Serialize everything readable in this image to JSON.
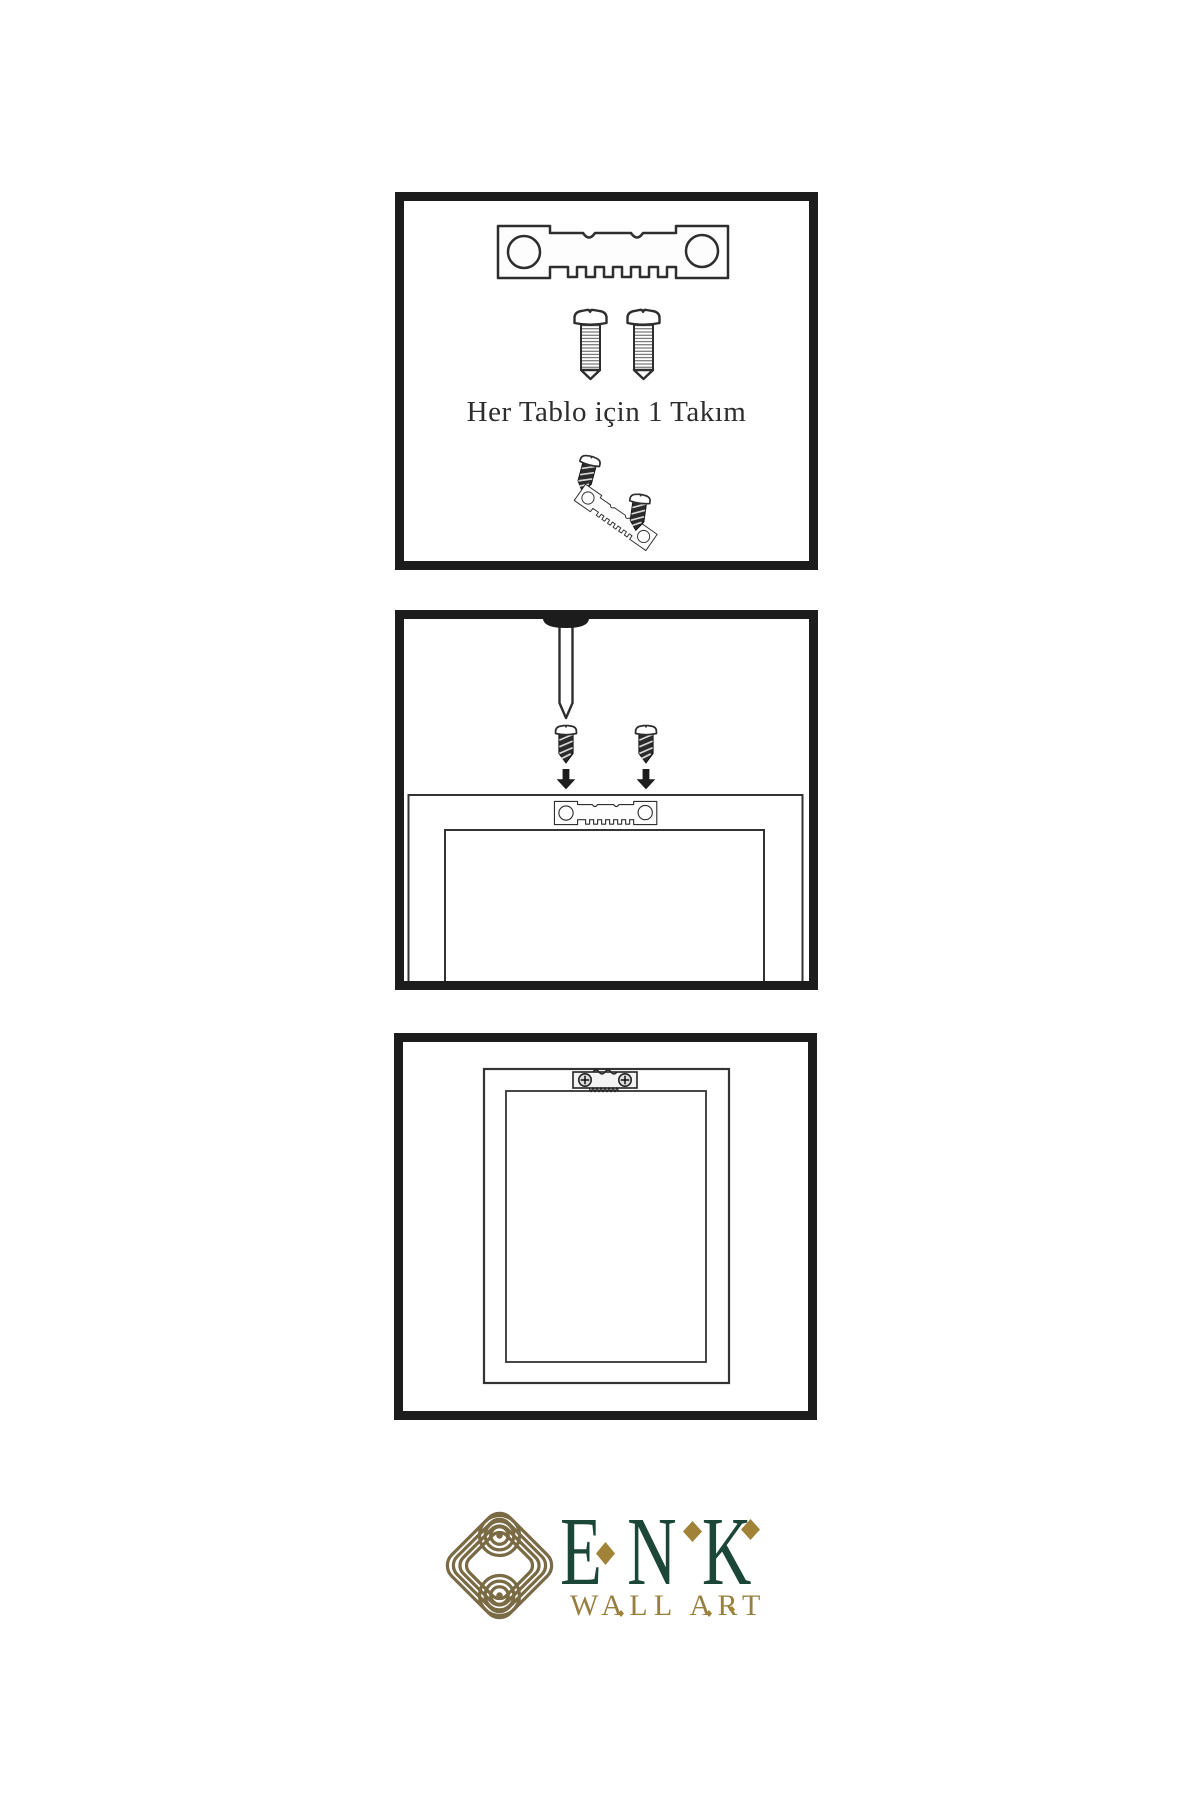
{
  "colors": {
    "paper": "#ffffff",
    "ink": "#1c1c1c",
    "line": "#2e2e2e",
    "text": "#2d2d2d",
    "green": "#1b4638",
    "gold": "#a08336",
    "knot": "#7a6b45",
    "subtitle": "#97803f",
    "screwdark": "#2b2b2b"
  },
  "panels": {
    "kit": {
      "caption": "Her Tablo için 1 Takım"
    }
  },
  "logo": {
    "name": "ENK",
    "subtitle": "WALL ART"
  }
}
